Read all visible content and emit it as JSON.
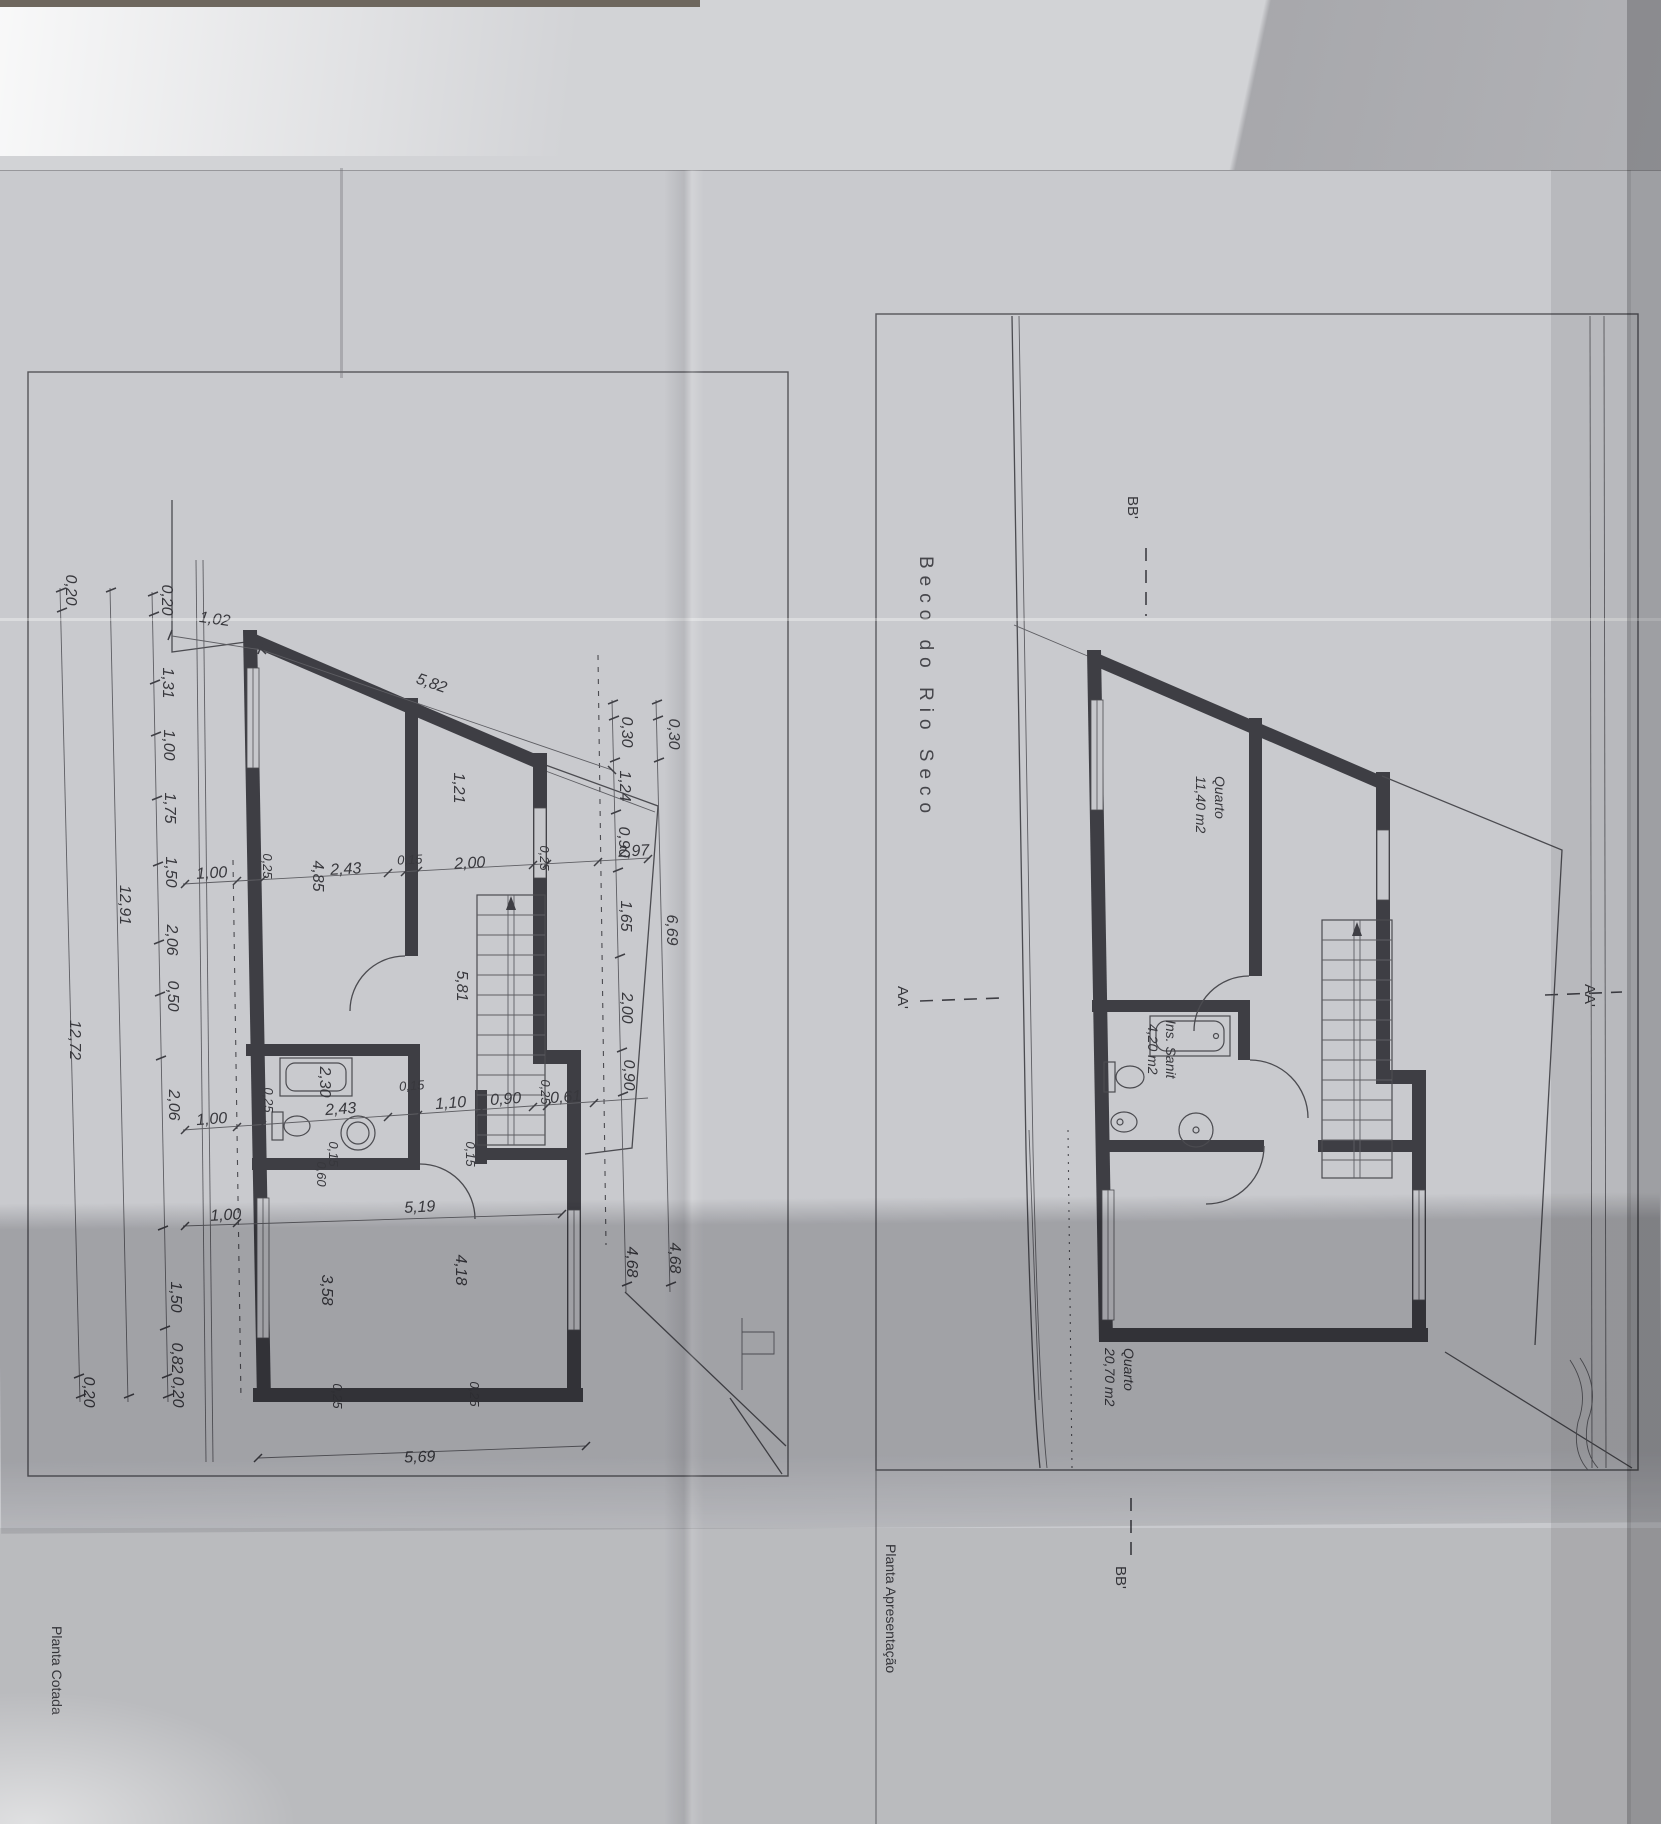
{
  "street": "Beco do Rio Seco",
  "titles": {
    "left": "Planta Cotada",
    "right": "Planta Apresentação"
  },
  "sections": {
    "bb_top": "BB'",
    "aa_left": "AA'",
    "aa_right": "AA'",
    "bb_bottom": "BB'"
  },
  "rooms": {
    "quarto1": {
      "name": "Quarto",
      "area": "11,40 m2"
    },
    "sanit": {
      "name": "Ins. Sanit",
      "area": "4,20 m2"
    },
    "quarto2": {
      "name": "Quarto",
      "area": "20,70 m2"
    }
  },
  "dims": {
    "top_offset": "1,02",
    "top_wall": "5,82",
    "left_chain": [
      "0,20",
      "1,31",
      "1,00",
      "1,75",
      "1,50",
      "2,06",
      "0,50",
      "2,06",
      "1,50",
      "0,82",
      "0,20"
    ],
    "left_inner_total": "12,91",
    "left_outer_total": "12,72",
    "left_outer_top": "0,20",
    "left_outer_bottom": "0,20",
    "chain1": [
      "1,00",
      "0,25",
      "4,85",
      "2,43",
      "0,15",
      "2,00",
      "0,25",
      "2,97"
    ],
    "right_chain": [
      "0,30",
      "1,24",
      "0,90",
      "1,65",
      "2,00",
      "0,90",
      "4,68"
    ],
    "right_outer": [
      "0,30",
      "6,69",
      "4,68"
    ],
    "chain2": [
      "1,00",
      "0,25",
      "2,30",
      "2,43",
      "0,15",
      "1,10",
      "0,90",
      "0,25",
      "0,61"
    ],
    "bath": [
      "0,15",
      "0,60",
      "0,15"
    ],
    "hall_width": "1,21",
    "hall_depth": "5,81",
    "room_chain": [
      "1,00",
      "5,19"
    ],
    "room_left": "3,58",
    "room_mid": "4,18",
    "wall_marks": [
      "0,25",
      "0,25"
    ],
    "bottom_total": "5,69"
  }
}
